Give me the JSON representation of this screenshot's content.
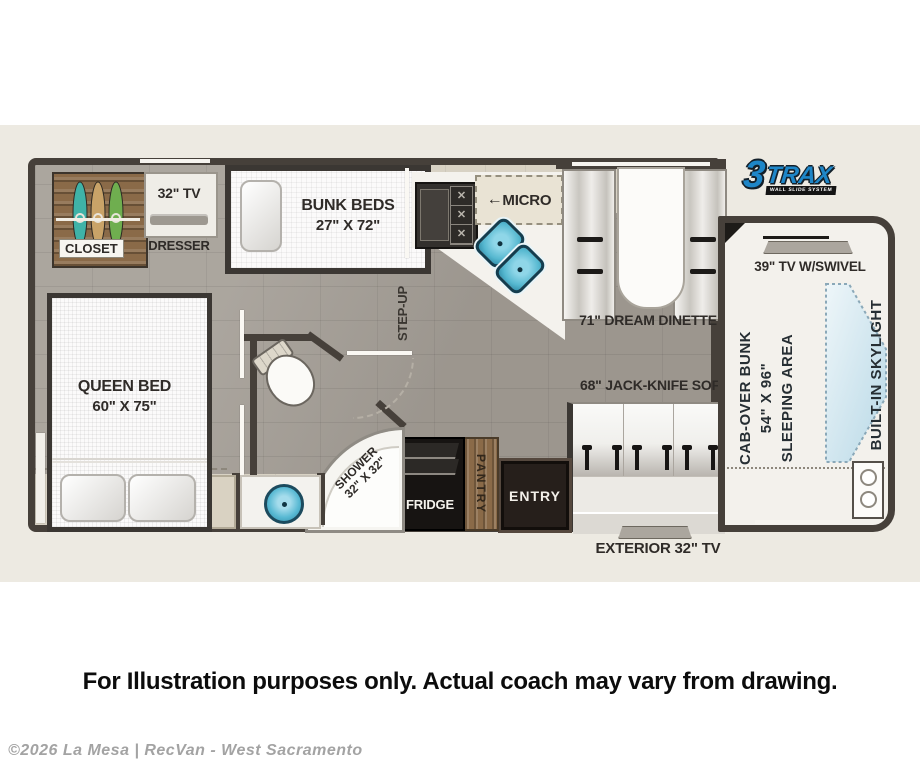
{
  "page": {
    "disclaimer": "For Illustration purposes only.  Actual coach may vary from drawing.",
    "copyright": "©2026 La Mesa | RecVan - West Sacramento"
  },
  "logo": {
    "number": "3",
    "name": "TRAX",
    "tagline": "WALL SLIDE SYSTEM"
  },
  "plan": {
    "labels": {
      "closet": "CLOSET",
      "tv32": "32\" TV",
      "dresser": "DRESSER",
      "bunk_line1": "BUNK BEDS",
      "bunk_line2": "27\" X 72\"",
      "micro_arrow": "←",
      "micro": "MICRO",
      "step_up": "STEP-UP",
      "dinette": "71\" DREAM DINETTE",
      "tv39": "39\" TV W/SWIVEL",
      "cab_line1": "CAB-OVER BUNK",
      "cab_line2": "54\" X 96\"",
      "cab_line3": "SLEEPING AREA",
      "skylight": "BUILT-IN SKYLIGHT",
      "sofa": "68\" JACK-KNIFE SOFA",
      "entry": "ENTRY",
      "pantry": "PANTRY",
      "fridge": "FRIDGE",
      "shower_line1": "SHOWER",
      "shower_line2": "32\" X 32\"",
      "queen_line1": "QUEEN BED",
      "queen_line2": "60\" X 75\"",
      "exterior_tv": "EXTERIOR 32\" TV"
    },
    "colors": {
      "wall": "#46403a",
      "floor": "#a49e96",
      "slide_floor": "#d8d2c4",
      "wood": "#8a6a48",
      "sink_blue": "#56b8d0",
      "logo_blue": "#1e86c8",
      "background_band": "#edeae2"
    }
  }
}
